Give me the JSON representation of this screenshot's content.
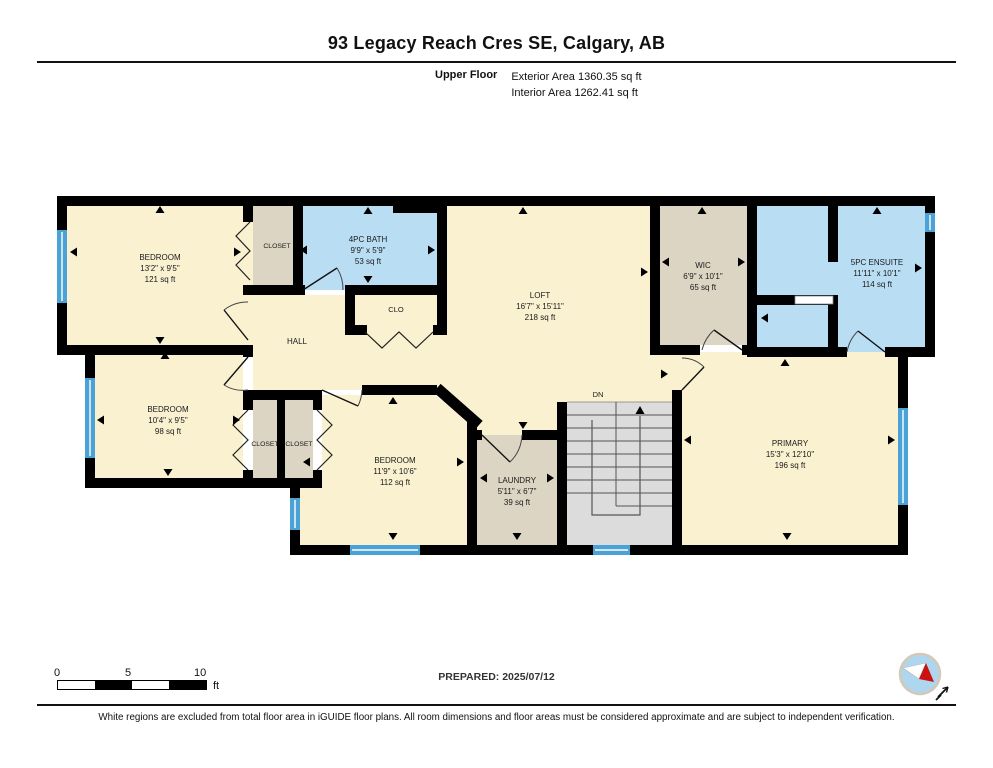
{
  "header": {
    "title": "93 Legacy Reach Cres SE, Calgary, AB",
    "floor_label": "Upper Floor",
    "exterior_area": "Exterior Area 1360.35 sq ft",
    "interior_area": "Interior Area 1262.41 sq ft"
  },
  "rooms": {
    "bedroom1": {
      "name": "BEDROOM",
      "dims": "13'2\" x 9'5\"",
      "area": "121 sq ft"
    },
    "closet1": {
      "name": "CLOSET"
    },
    "bath": {
      "name": "4PC BATH",
      "dims": "9'9\" x 5'9\"",
      "area": "53 sq ft"
    },
    "clo": {
      "name": "CLO"
    },
    "hall": {
      "name": "HALL"
    },
    "loft": {
      "name": "LOFT",
      "dims": "16'7\" x 15'11\"",
      "area": "218 sq ft"
    },
    "wic": {
      "name": "WIC",
      "dims": "6'9\" x 10'1\"",
      "area": "65 sq ft"
    },
    "ensuite": {
      "name": "5PC ENSUITE",
      "dims": "11'11\" x 10'1\"",
      "area": "114 sq ft"
    },
    "bedroom2": {
      "name": "BEDROOM",
      "dims": "10'4\" x 9'5\"",
      "area": "98 sq ft"
    },
    "closet2": {
      "name": "CLOSET"
    },
    "closet3": {
      "name": "CLOSET"
    },
    "bedroom3": {
      "name": "BEDROOM",
      "dims": "11'9\" x 10'6\"",
      "area": "112 sq ft"
    },
    "laundry": {
      "name": "LAUNDRY",
      "dims": "5'11\" x 6'7\"",
      "area": "39 sq ft"
    },
    "primary": {
      "name": "PRIMARY",
      "dims": "15'3\" x 12'10\"",
      "area": "196 sq ft"
    },
    "stairs": {
      "label": "DN"
    }
  },
  "colors": {
    "room_cream": "#faf1d1",
    "room_blue": "#b9def4",
    "room_tan": "#ddd5c4",
    "stairs_gray": "#dcdcdc",
    "window_blue": "#4aa2d6",
    "wall_black": "#000000"
  },
  "scale_bar": {
    "tick0": "0",
    "tick1": "5",
    "tick2": "10",
    "unit": "ft"
  },
  "footer": {
    "prepared": "PREPARED: 2025/07/12",
    "disclaimer": "White regions are excluded from total floor area in iGUIDE floor plans. All room dimensions and floor areas must be considered approximate and are subject to independent verification."
  }
}
